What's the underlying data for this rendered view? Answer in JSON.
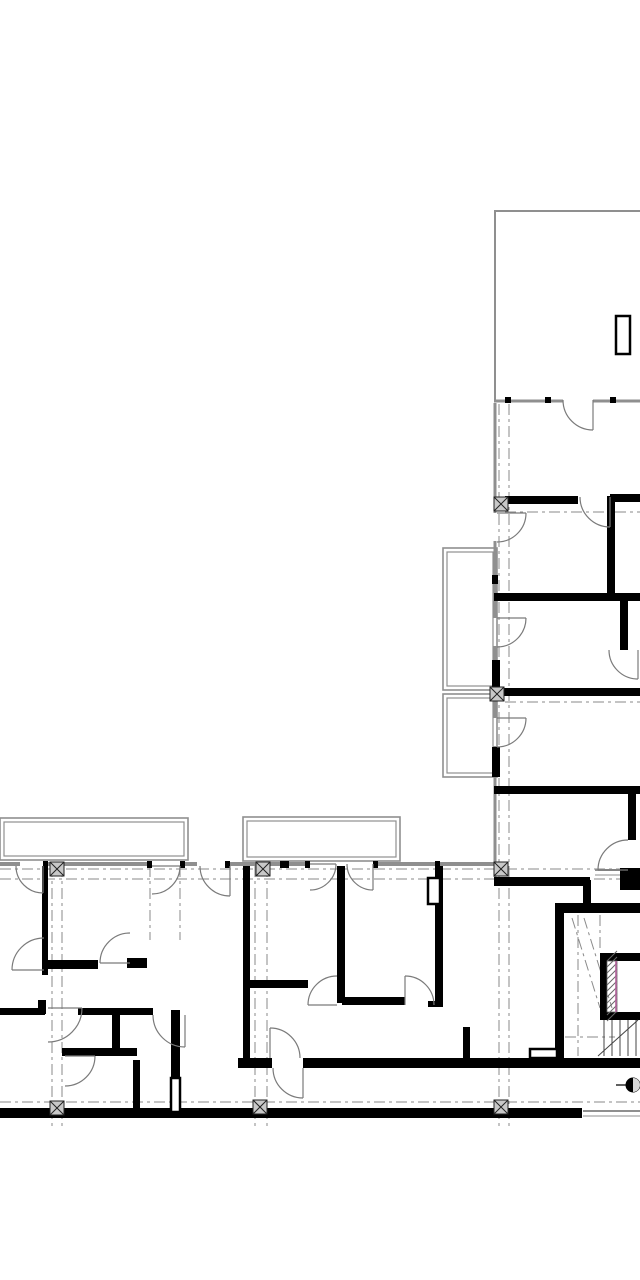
{
  "canvas": {
    "width": 640,
    "height": 1280,
    "background": "#ffffff"
  },
  "colors": {
    "wall": "#000000",
    "thin_wall": "#8f8f8f",
    "grid": "#8a8a8a",
    "door": "#7a7a7a",
    "column_fill": "#c8c8c8",
    "column_stroke": "#222222",
    "hatch": "#666666",
    "accent": "#b2609a",
    "tread": "#444444",
    "marker": "#000000"
  },
  "layers": {
    "balconies": [
      [
        0,
        818,
        188,
        42
      ],
      [
        243,
        817,
        157,
        44
      ],
      [
        443,
        548,
        54,
        142
      ],
      [
        443,
        694,
        54,
        83
      ]
    ],
    "thin_walls": [
      [
        0,
        864,
        20,
        864,
        4
      ],
      [
        43,
        864,
        152,
        864,
        4
      ],
      [
        180,
        864,
        197,
        864,
        4
      ],
      [
        230,
        864,
        310,
        864,
        4
      ],
      [
        373,
        864,
        440,
        864,
        4
      ],
      [
        440,
        864,
        494,
        864,
        4
      ],
      [
        494,
        401,
        563,
        401,
        3
      ],
      [
        593,
        401,
        640,
        401,
        3
      ],
      [
        494,
        211,
        640,
        211,
        2
      ],
      [
        495,
        211,
        495,
        400,
        2
      ],
      [
        495,
        403,
        495,
        513,
        3
      ],
      [
        495,
        541,
        495,
        618,
        3
      ],
      [
        495,
        646,
        495,
        718,
        3
      ],
      [
        495,
        746,
        495,
        877,
        3
      ],
      [
        583,
        1111,
        640,
        1111,
        2
      ],
      [
        583,
        1116,
        640,
        1116,
        1
      ],
      [
        595,
        870,
        620,
        870,
        2
      ],
      [
        595,
        875,
        620,
        875,
        1
      ]
    ],
    "grid_dashed": [
      [
        52,
        866,
        52,
        1130
      ],
      [
        62,
        866,
        62,
        1130
      ],
      [
        150,
        866,
        150,
        940
      ],
      [
        180,
        866,
        180,
        940
      ],
      [
        255,
        866,
        255,
        1130
      ],
      [
        267,
        866,
        267,
        1130
      ],
      [
        499,
        404,
        499,
        1130
      ],
      [
        509,
        404,
        509,
        1130
      ],
      [
        578,
        915,
        578,
        1056
      ],
      [
        600,
        915,
        600,
        951
      ],
      [
        505,
        512,
        640,
        512
      ],
      [
        505,
        702,
        640,
        702
      ],
      [
        0,
        869,
        640,
        869
      ],
      [
        0,
        879,
        640,
        879
      ],
      [
        0,
        1102,
        640,
        1102
      ],
      [
        565,
        1037,
        615,
        1037
      ],
      [
        572,
        918,
        600,
        1008
      ],
      [
        584,
        918,
        612,
        1008
      ]
    ],
    "walls": [
      [
        505,
        496,
        73,
        8
      ],
      [
        610,
        494,
        30,
        8
      ],
      [
        607,
        496,
        8,
        102
      ],
      [
        494,
        593,
        146,
        8
      ],
      [
        620,
        601,
        8,
        49
      ],
      [
        494,
        688,
        146,
        8
      ],
      [
        494,
        786,
        146,
        8
      ],
      [
        628,
        794,
        8,
        46
      ],
      [
        620,
        868,
        20,
        22
      ],
      [
        494,
        877,
        96,
        9
      ],
      [
        583,
        880,
        8,
        33
      ],
      [
        562,
        903,
        78,
        10
      ],
      [
        555,
        903,
        9,
        165
      ],
      [
        492,
        660,
        8,
        33
      ],
      [
        492,
        747,
        8,
        30
      ],
      [
        600,
        953,
        40,
        8
      ],
      [
        600,
        1012,
        40,
        8
      ],
      [
        600,
        953,
        7,
        67
      ],
      [
        238,
        1058,
        34,
        10
      ],
      [
        303,
        1058,
        337,
        10
      ],
      [
        463,
        1027,
        7,
        36
      ],
      [
        0,
        1108,
        580,
        10
      ],
      [
        337,
        866,
        8,
        137
      ],
      [
        435,
        866,
        8,
        141
      ],
      [
        428,
        1001,
        15,
        6
      ],
      [
        342,
        997,
        63,
        8
      ],
      [
        435,
        997,
        8,
        8
      ],
      [
        243,
        866,
        7,
        194
      ],
      [
        250,
        980,
        58,
        8
      ],
      [
        42,
        866,
        6,
        109
      ],
      [
        45,
        960,
        53,
        9
      ],
      [
        127,
        958,
        20,
        10
      ],
      [
        0,
        1008,
        45,
        7
      ],
      [
        78,
        1008,
        75,
        7
      ],
      [
        112,
        1015,
        8,
        40
      ],
      [
        62,
        1048,
        75,
        8
      ],
      [
        133,
        1060,
        7,
        52
      ],
      [
        171,
        1010,
        9,
        70
      ],
      [
        38,
        1000,
        8,
        14
      ],
      [
        505,
        397,
        6,
        6
      ],
      [
        545,
        397,
        6,
        6
      ],
      [
        610,
        397,
        6,
        6
      ],
      [
        43,
        861,
        5,
        7
      ],
      [
        147,
        861,
        5,
        7
      ],
      [
        180,
        861,
        5,
        7
      ],
      [
        225,
        861,
        5,
        7
      ],
      [
        305,
        861,
        5,
        7
      ],
      [
        373,
        861,
        5,
        7
      ],
      [
        280,
        861,
        9,
        7
      ],
      [
        435,
        861,
        5,
        7
      ],
      [
        492,
        575,
        6,
        9
      ],
      [
        570,
        1108,
        12,
        10
      ]
    ],
    "outlined_features": [
      [
        616,
        316,
        14,
        38
      ],
      [
        428,
        878,
        12,
        26
      ],
      [
        530,
        1049,
        27,
        9
      ],
      [
        171,
        1078,
        9,
        34
      ]
    ],
    "columns": [
      [
        501,
        504
      ],
      [
        497,
        694
      ],
      [
        57,
        869
      ],
      [
        263,
        869
      ],
      [
        501,
        869
      ],
      [
        57,
        1108
      ],
      [
        260,
        1107
      ],
      [
        501,
        1107
      ]
    ],
    "doors": [
      [
        593,
        400,
        30,
        90,
        180
      ],
      [
        610,
        497,
        30,
        90,
        180
      ],
      [
        497,
        513,
        29,
        0,
        90
      ],
      [
        497,
        618,
        29,
        0,
        90
      ],
      [
        497,
        718,
        29,
        0,
        90
      ],
      [
        638,
        650,
        29,
        90,
        180
      ],
      [
        628,
        870,
        30,
        180,
        270
      ],
      [
        310,
        864,
        26,
        0,
        90
      ],
      [
        373,
        864,
        26,
        90,
        180
      ],
      [
        43,
        866,
        27,
        90,
        180
      ],
      [
        152,
        866,
        28,
        0,
        90
      ],
      [
        230,
        866,
        30,
        90,
        180
      ],
      [
        130,
        963,
        30,
        180,
        270
      ],
      [
        44,
        970,
        32,
        180,
        270
      ],
      [
        48,
        1008,
        34,
        0,
        90
      ],
      [
        185,
        1015,
        32,
        90,
        180
      ],
      [
        65,
        1056,
        30,
        0,
        90
      ],
      [
        303,
        1068,
        30,
        90,
        180
      ],
      [
        270,
        1058,
        30,
        270,
        360
      ],
      [
        337,
        1005,
        29,
        180,
        270
      ],
      [
        405,
        1005,
        29,
        270,
        360
      ]
    ],
    "stair_treads": [
      [
        604,
        1020,
        604,
        1056
      ],
      [
        612,
        1020,
        612,
        1056
      ],
      [
        620,
        1020,
        620,
        1056
      ],
      [
        628,
        1020,
        628,
        1056
      ],
      [
        636,
        1020,
        636,
        1056
      ],
      [
        598,
        1056,
        638,
        1020
      ]
    ],
    "elevator_hatch": {
      "x": 607,
      "y": 961,
      "w": 10,
      "h": 51,
      "accent_x": 616
    },
    "section_marker": {
      "cx": 633,
      "cy": 1085,
      "r": 7,
      "tail_x": 616
    }
  }
}
